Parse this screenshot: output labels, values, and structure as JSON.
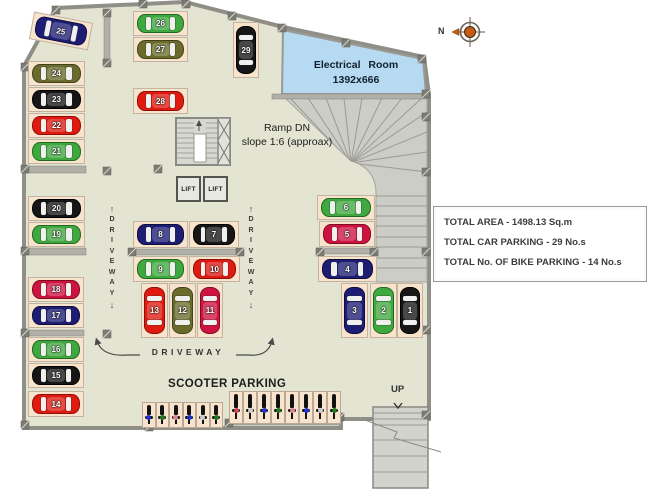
{
  "labels": {
    "electrical_room": "Electrical Room",
    "electrical_room_size": "1392x666",
    "ramp_line1": "Ramp DN",
    "ramp_line2": "slope 1:6 (approax)",
    "lift": "LIFT",
    "driveway": "DRIVEWAY",
    "scooter_parking": "SCOOTER PARKING",
    "up": "UP",
    "north": "N"
  },
  "info_panel": {
    "lines": [
      "TOTAL AREA - 1498.13 Sq.m",
      "TOTAL CAR PARKING - 29 No.s",
      "TOTAL No. OF BIKE PARKING - 14 No.s"
    ]
  },
  "colors": {
    "floor": "#e3e4d2",
    "stall": "#f8e3cd",
    "wall": "#8f8f87",
    "electrical_room": "#b5daf1",
    "ramp": "#cdcdc7",
    "compass": "#c75c10",
    "palette": {
      "navy": {
        "body": "#1d1d74",
        "edge": "#0c0c3e"
      },
      "black": {
        "body": "#161616",
        "edge": "#000000"
      },
      "red": {
        "body": "#e01a10",
        "edge": "#8e0f08"
      },
      "crimson": {
        "body": "#cf1340",
        "edge": "#7e0b26"
      },
      "green": {
        "body": "#3fa83f",
        "edge": "#1f6a1f"
      },
      "olive": {
        "body": "#6b6c2b",
        "edge": "#41421a"
      }
    }
  },
  "plan": {
    "total_car_spots": 29,
    "total_bike_spots": 14,
    "cars": [
      {
        "n": 25,
        "c": "navy",
        "x": 31,
        "y": 17,
        "w": 60,
        "h": 28,
        "o": "h",
        "rot": 11
      },
      {
        "n": 24,
        "c": "olive",
        "x": 28,
        "y": 61,
        "w": 57,
        "h": 25,
        "o": "h"
      },
      {
        "n": 23,
        "c": "black",
        "x": 28,
        "y": 87,
        "w": 57,
        "h": 25,
        "o": "h"
      },
      {
        "n": 22,
        "c": "red",
        "x": 28,
        "y": 113,
        "w": 57,
        "h": 25,
        "o": "h"
      },
      {
        "n": 21,
        "c": "green",
        "x": 28,
        "y": 139,
        "w": 57,
        "h": 25,
        "o": "h"
      },
      {
        "n": 20,
        "c": "black",
        "x": 28,
        "y": 196,
        "w": 57,
        "h": 25,
        "o": "h"
      },
      {
        "n": 19,
        "c": "green",
        "x": 28,
        "y": 222,
        "w": 57,
        "h": 25,
        "o": "h"
      },
      {
        "n": 18,
        "c": "crimson",
        "x": 28,
        "y": 277,
        "w": 56,
        "h": 25,
        "o": "h"
      },
      {
        "n": 17,
        "c": "navy",
        "x": 28,
        "y": 303,
        "w": 56,
        "h": 25,
        "o": "h"
      },
      {
        "n": 16,
        "c": "green",
        "x": 28,
        "y": 337,
        "w": 56,
        "h": 25,
        "o": "h"
      },
      {
        "n": 15,
        "c": "black",
        "x": 28,
        "y": 363,
        "w": 56,
        "h": 25,
        "o": "h"
      },
      {
        "n": 14,
        "c": "red",
        "x": 28,
        "y": 391,
        "w": 56,
        "h": 26,
        "o": "h"
      },
      {
        "n": 26,
        "c": "green",
        "x": 133,
        "y": 11,
        "w": 55,
        "h": 25,
        "o": "h"
      },
      {
        "n": 27,
        "c": "olive",
        "x": 133,
        "y": 37,
        "w": 55,
        "h": 25,
        "o": "h"
      },
      {
        "n": 28,
        "c": "red",
        "x": 133,
        "y": 88,
        "w": 55,
        "h": 26,
        "o": "h"
      },
      {
        "n": 29,
        "c": "black",
        "x": 233,
        "y": 22,
        "w": 26,
        "h": 56,
        "o": "v"
      },
      {
        "n": 8,
        "c": "navy",
        "x": 133,
        "y": 221,
        "w": 55,
        "h": 27,
        "o": "h"
      },
      {
        "n": 7,
        "c": "black",
        "x": 189,
        "y": 221,
        "w": 50,
        "h": 27,
        "o": "h"
      },
      {
        "n": 9,
        "c": "green",
        "x": 133,
        "y": 256,
        "w": 55,
        "h": 26,
        "o": "h"
      },
      {
        "n": 10,
        "c": "red",
        "x": 189,
        "y": 256,
        "w": 51,
        "h": 26,
        "o": "h"
      },
      {
        "n": 13,
        "c": "red",
        "x": 141,
        "y": 283,
        "w": 27,
        "h": 55,
        "o": "v"
      },
      {
        "n": 12,
        "c": "olive",
        "x": 169,
        "y": 283,
        "w": 27,
        "h": 55,
        "o": "v"
      },
      {
        "n": 11,
        "c": "crimson",
        "x": 197,
        "y": 283,
        "w": 26,
        "h": 55,
        "o": "v"
      },
      {
        "n": 6,
        "c": "green",
        "x": 317,
        "y": 195,
        "w": 58,
        "h": 25,
        "o": "h"
      },
      {
        "n": 5,
        "c": "crimson",
        "x": 319,
        "y": 221,
        "w": 56,
        "h": 26,
        "o": "h"
      },
      {
        "n": 4,
        "c": "navy",
        "x": 318,
        "y": 256,
        "w": 59,
        "h": 26,
        "o": "h"
      },
      {
        "n": 3,
        "c": "navy",
        "x": 341,
        "y": 283,
        "w": 27,
        "h": 55,
        "o": "v"
      },
      {
        "n": 2,
        "c": "green",
        "x": 370,
        "y": 283,
        "w": 27,
        "h": 55,
        "o": "v"
      },
      {
        "n": 1,
        "c": "black",
        "x": 397,
        "y": 283,
        "w": 26,
        "h": 55,
        "o": "v"
      }
    ],
    "scooter_groups": [
      {
        "x": 142,
        "y": 402,
        "stall_w": 13.5,
        "stall_h": 26,
        "dots": [
          "#2233cc",
          "#227722",
          "#dd8899",
          "#2233cc",
          "#cccccc",
          "#227722"
        ]
      },
      {
        "x": 229,
        "y": 391,
        "stall_w": 14,
        "stall_h": 33,
        "dots": [
          "#cc4455",
          "#cccccc",
          "#2233cc",
          "#227722",
          "#dd8899",
          "#2233cc",
          "#cccccc",
          "#227722"
        ]
      }
    ]
  }
}
